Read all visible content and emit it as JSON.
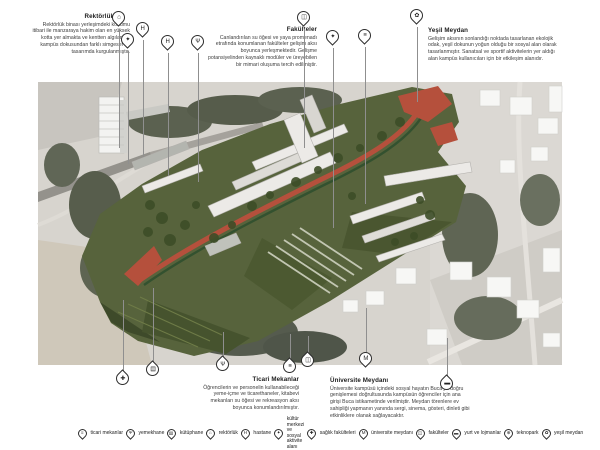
{
  "colors": {
    "accent_red": "#b5503c",
    "campus_green": "#57633c",
    "photo_gray": "#d7d4ce",
    "pin_outline": "#2d2d2d"
  },
  "annotations": {
    "rektorluk": {
      "title": "Rektörlük",
      "body": "Rektörlük binası yerleşimdeki konumu itibari ile manzaraya hakim olan en yüksek kotta yer almakta ve kentten algılanan, kampüs dokusundan farklı simgesel bir tasarımda kurgulanmıştır."
    },
    "fakulteler": {
      "title": "Fakülteler",
      "body": "Canlandırılan su öğesi ve yaya promenadı etrafında konumlanan fakülteler gelişim aksı boyunca yerleşmektedir. Gelişme potansiyelinden kaynaklı modüler ve üreyebilen bir mimari oluşuma tercih edilmiştir."
    },
    "yesil_meydan": {
      "title": "Yeşil Meydan",
      "body": "Gelişim aksının sonlandığı noktada tasarlanan ekolojik odak, yeşil dokunun yoğun olduğu bir sosyal alan olarak tasarlanmıştır. Sanatsal ve sportif aktivitelerin yer aldığı alan kampüs kullanıcıları için bir etkileşim alanıdır."
    },
    "ticari_mekanlar": {
      "title": "Ticari Mekanlar",
      "body": "Öğrencilerin ve personelin kullanabileceği yeme-içme ve ticarethaneler, kitabevi mekanları su öğesi ve rekreasyon aksı boyunca konumlandırılmıştır."
    },
    "universite_meydani": {
      "title": "Üniversite Meydanı",
      "body": "Üniversite kampüsü içindeki sosyal hayatın Buca'ya doğru genişlemesi doğrultusunda kampüsün öğrenciler için ana girişi Buca istikametinde verilmiştir. Meydan törenlere ev sahipliği yapmanın yanında sergi, sinema, gösteri, dinleti gibi etkinliklere olanak sağlayacaktır."
    }
  },
  "legend": {
    "items": [
      {
        "id": "ticari-mekanlar",
        "glyph": "≡",
        "label": "ticari mekanlar"
      },
      {
        "id": "yemekhane",
        "glyph": "Ψ",
        "label": "yemekhane"
      },
      {
        "id": "kutuphane",
        "glyph": "▤",
        "label": "kütüphane"
      },
      {
        "id": "rektorluk",
        "glyph": "⌂",
        "label": "rektörlük"
      },
      {
        "id": "hastane",
        "glyph": "H",
        "label": "hastane"
      },
      {
        "id": "kultur-merkezi",
        "glyph": "✦",
        "label": "kültür merkezi ve sosyal aktivite alanı"
      },
      {
        "id": "saglik-fakulteleri",
        "glyph": "✚",
        "label": "sağlık fakülteleri"
      },
      {
        "id": "universite-meydani",
        "glyph": "M",
        "label": "üniversite meydanı"
      },
      {
        "id": "fakulteler",
        "glyph": "◫",
        "label": "fakülteler"
      },
      {
        "id": "yurt-ve-lojmanlar",
        "glyph": "▬",
        "label": "yurt ve lojmanlar"
      },
      {
        "id": "teknopark",
        "glyph": "⊕",
        "label": "teknopark"
      },
      {
        "id": "yesil-meydan",
        "glyph": "✿",
        "label": "yeşil meydan"
      }
    ]
  },
  "pins": [
    {
      "id": "rektorluk",
      "glyph": "⌂",
      "dir": "down",
      "x": 119,
      "y": 20,
      "leader": [
        29,
        148
      ]
    },
    {
      "id": "kultur-merkezi",
      "glyph": "✦",
      "dir": "down",
      "x": 128,
      "y": 42,
      "leader": [
        51,
        164
      ]
    },
    {
      "id": "hastane",
      "glyph": "H",
      "dir": "down",
      "x": 143,
      "y": 31,
      "leader": [
        40,
        157
      ]
    },
    {
      "id": "hastane",
      "glyph": "H",
      "dir": "down",
      "x": 168,
      "y": 44,
      "leader": [
        53,
        176
      ]
    },
    {
      "id": "yemekhane",
      "glyph": "Ψ",
      "dir": "down",
      "x": 198,
      "y": 44,
      "leader": [
        53,
        182
      ]
    },
    {
      "id": "fakulteler",
      "glyph": "◫",
      "dir": "down",
      "x": 304,
      "y": 20,
      "leader": [
        29,
        148
      ]
    },
    {
      "id": "kultur-merkezi",
      "glyph": "✦",
      "dir": "down",
      "x": 333,
      "y": 39,
      "leader": [
        48,
        228
      ]
    },
    {
      "id": "ticari-mekanlar",
      "glyph": "≡",
      "dir": "down",
      "x": 365,
      "y": 38,
      "leader": [
        47,
        204
      ]
    },
    {
      "id": "yesil-meydan",
      "glyph": "✿",
      "dir": "down",
      "x": 417,
      "y": 18,
      "leader": [
        27,
        102
      ]
    },
    {
      "id": "saglik-fakulteleri",
      "glyph": "✚",
      "dir": "up",
      "x": 123,
      "y": 381,
      "leader": [
        300,
        372
      ]
    },
    {
      "id": "kutuphane",
      "glyph": "▤",
      "dir": "up",
      "x": 153,
      "y": 372,
      "leader": [
        288,
        363
      ]
    },
    {
      "id": "yemekhane",
      "glyph": "Ψ",
      "dir": "up",
      "x": 223,
      "y": 367,
      "leader": [
        332,
        358
      ]
    },
    {
      "id": "ticari-mekanlar",
      "glyph": "≡",
      "dir": "up",
      "x": 290,
      "y": 369,
      "leader": [
        334,
        360
      ]
    },
    {
      "id": "fakulteler",
      "glyph": "◫",
      "dir": "up",
      "x": 308,
      "y": 363,
      "leader": [
        336,
        354
      ]
    },
    {
      "id": "universite-meydani",
      "glyph": "M",
      "dir": "down",
      "x": 366,
      "y": 361,
      "leader": [
        308,
        352
      ]
    },
    {
      "id": "yurt-ve-lojmanlar",
      "glyph": "▬",
      "dir": "up",
      "x": 447,
      "y": 386,
      "leader": [
        338,
        377
      ]
    }
  ]
}
